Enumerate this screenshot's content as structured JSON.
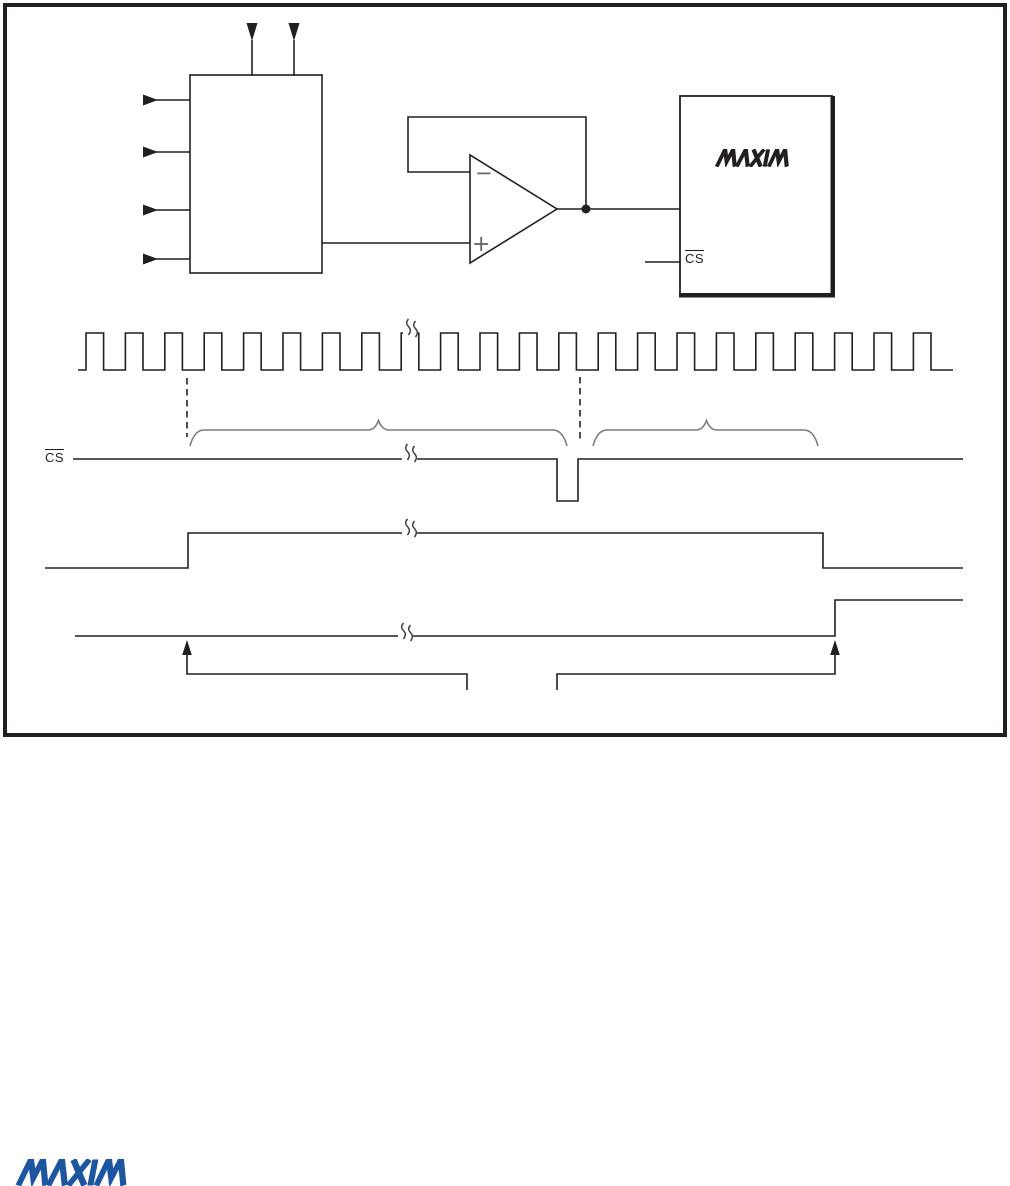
{
  "colors": {
    "ink": "#231f20",
    "brace_gray": "#7c7c7c",
    "logo_blue": "#1d56a0",
    "comparator_sign_gray": "#666666"
  },
  "circuit": {
    "chip": {
      "logo_text": "MAXIM",
      "cs_pin_label": "CS"
    },
    "comparator": {
      "minus_label": "−",
      "plus_label": "+"
    }
  },
  "timing": {
    "cs_signal_label": "CS",
    "clock": {
      "x_start": 78,
      "first_rise": 86,
      "period": 39.4,
      "pulse_count": 22,
      "high_width": 17.6,
      "y_high": 333,
      "y_low": 370,
      "x_end": 953
    },
    "cs_wave_points": "73,459 557,459 557,501 578,501 578,459 963,459",
    "data_wave1_points": "45,568 188,568 188,533 823,533 823,568 963,568",
    "data_wave2_points": "75,636 835,636 835,600 963,600"
  },
  "footer": {
    "logo_text": "MAXIM"
  }
}
